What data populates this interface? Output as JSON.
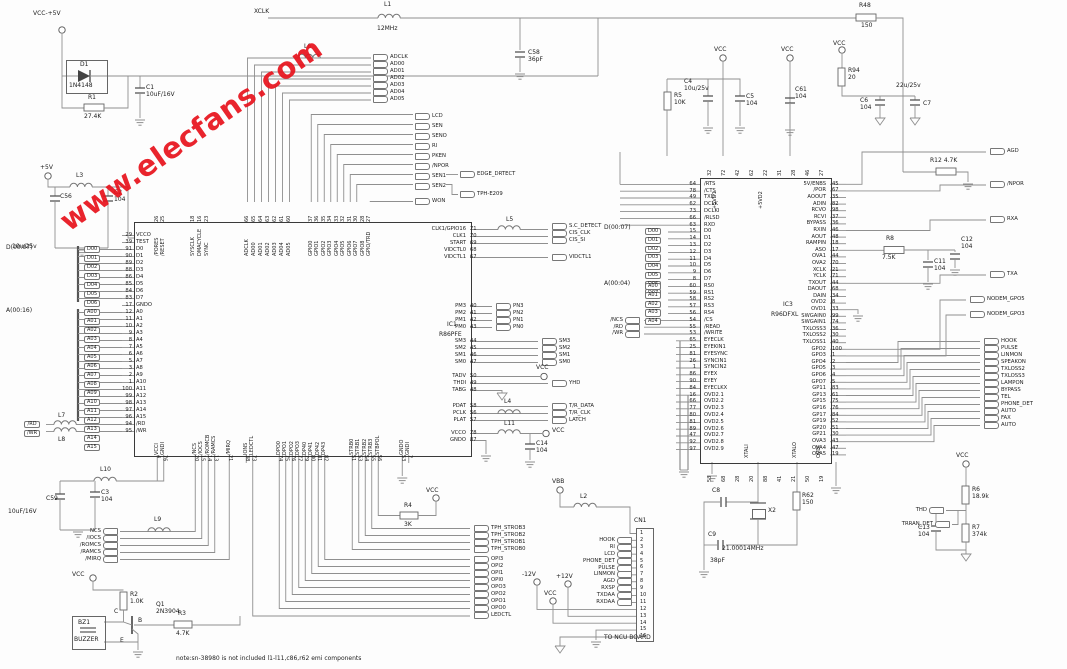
{
  "watermark": "www.elecfans.com",
  "note": "note:sn-38980 is not included l1-l11,c86,r62 emi components",
  "labels": {
    "vcc5": "VCC-+5V",
    "p5v": "+5V",
    "vcc": "VCC",
    "vbb": "VBB",
    "m12": "-12V",
    "p12": "+12V",
    "xclk": "XCLK",
    "to_ncu": "TO NCU BOARD",
    "cn1": "CN1",
    "d_bus1": "D(00:07)",
    "a_bus1": "A(00:16)",
    "d_bus3": "D(00:07)",
    "a_bus3": "A(00:04)",
    "p5vd1": "+5VD1",
    "p5vd2": "+5VD2",
    "xtali": "XTALI",
    "xtalo": "XTALO",
    "ovdi": "OVDI",
    "v22": "22u/25v",
    "b": "B",
    "c": "C",
    "e": "E",
    "won": "WON",
    "edge": "EDGE_DRTECT",
    "tph_e209": "TPH-E209",
    "vidctl1": "VIDCTL1",
    "yhd": "YHD",
    "ledctl": "LEDCTL",
    "agd": "AGD",
    "npor": "/NPOR",
    "rxa": "RXA",
    "txa": "TXA",
    "m5": "NODEM_GPO5",
    "m3": "NODEM_GPO3",
    "thd": "THD",
    "trran": "TRRAN_DET"
  },
  "parts": {
    "c1": {
      "n": "C1",
      "v": "10uF/16V"
    },
    "c2": {
      "n": "C2",
      "v": "104"
    },
    "c3": {
      "n": "C3",
      "v": "104"
    },
    "c4": {
      "n": "C4",
      "v": "10u/25v"
    },
    "c5": {
      "n": "C5",
      "v": "104"
    },
    "c6": {
      "n": "C6",
      "v": "104"
    },
    "c7": {
      "n": "C7",
      "v": "22u/25v"
    },
    "c8": {
      "n": "C8",
      "v": ""
    },
    "c9": {
      "n": "C9",
      "v": "38pF"
    },
    "c11": {
      "n": "C11",
      "v": "104"
    },
    "c12": {
      "n": "C12",
      "v": "104"
    },
    "c13": {
      "n": "C13",
      "v": "104"
    },
    "c14": {
      "n": "C14",
      "v": "104"
    },
    "c56": {
      "n": "C56",
      "v": "10u/25v"
    },
    "c58": {
      "n": "C58",
      "v": "36pF"
    },
    "c59": {
      "n": "C59",
      "v": "10uF/16V"
    },
    "c61": {
      "n": "C61",
      "v": "104"
    },
    "r1": {
      "n": "R1",
      "v": "27.4K"
    },
    "r2": {
      "n": "R2",
      "v": "1.0K"
    },
    "r3": {
      "n": "R3",
      "v": "4.7K"
    },
    "r4": {
      "n": "R4",
      "v": "3K"
    },
    "r5": {
      "n": "R5",
      "v": "10K"
    },
    "r6": {
      "n": "R6",
      "v": "18.9k"
    },
    "r7": {
      "n": "R7",
      "v": "374k"
    },
    "r8": {
      "n": "R8",
      "v": "7.5K"
    },
    "r12": {
      "n": "R12",
      "v": "4.7K"
    },
    "r48": {
      "n": "R48",
      "v": "150"
    },
    "r62": {
      "n": "R62",
      "v": "150"
    },
    "r94": {
      "n": "R94",
      "v": "20"
    },
    "d1": {
      "n": "D1",
      "v": "1N4148"
    },
    "q1": {
      "n": "Q1",
      "v": "2N3904"
    },
    "x2": {
      "n": "X2",
      "v": "21.00014MHz"
    },
    "bz1": {
      "n": "BZ1",
      "v": "BUZZER"
    },
    "l1": {
      "n": "L1",
      "v": "12MHz"
    },
    "l2": {
      "n": "L2"
    },
    "l3": {
      "n": "L3"
    },
    "l4": {
      "n": "L4"
    },
    "l5": {
      "n": "L5"
    },
    "l6": {
      "n": "L6"
    },
    "l7": {
      "n": "L7"
    },
    "l8": {
      "n": "L8"
    },
    "l9": {
      "n": "L9"
    },
    "l10": {
      "n": "L10"
    },
    "l11": {
      "n": "L11"
    }
  },
  "ic1": {
    "ref": "IC1",
    "part": "R86PFE",
    "top_a": [
      {
        "name": "/PORES",
        "pin": "26"
      },
      {
        "name": "/RESET",
        "pin": "25"
      }
    ],
    "top_b": [
      {
        "name": "SYSCLK",
        "pin": "18"
      },
      {
        "name": "DMACYCLE",
        "pin": "16"
      },
      {
        "name": "SYNC",
        "pin": "23"
      }
    ],
    "top_c": [
      {
        "name": "ADCLK",
        "pin": "66"
      },
      {
        "name": "AD00",
        "pin": "65"
      },
      {
        "name": "AD01",
        "pin": "64"
      },
      {
        "name": "AD02",
        "pin": "63"
      },
      {
        "name": "AD03",
        "pin": "62"
      },
      {
        "name": "AD04",
        "pin": "61"
      },
      {
        "name": "AD05",
        "pin": "60"
      }
    ],
    "top_d": [
      {
        "name": "GPIO0",
        "pin": "37"
      },
      {
        "name": "GPIO1",
        "pin": "36"
      },
      {
        "name": "GPIO2",
        "pin": "35"
      },
      {
        "name": "GPIO3",
        "pin": "34"
      },
      {
        "name": "GPIO4",
        "pin": "33"
      },
      {
        "name": "GPIO5",
        "pin": "32"
      },
      {
        "name": "GPIO6",
        "pin": "31"
      },
      {
        "name": "GPIO7",
        "pin": "30"
      },
      {
        "name": "GPIO8",
        "pin": "28"
      },
      {
        "name": "GPIO/TRD",
        "pin": "27"
      }
    ],
    "left": [
      {
        "name": "VCCO",
        "pin": "29"
      },
      {
        "name": "TEST",
        "pin": "39"
      },
      {
        "name": "D0",
        "pin": "91"
      },
      {
        "name": "D1",
        "pin": "90"
      },
      {
        "name": "D2",
        "pin": "89"
      },
      {
        "name": "D3",
        "pin": "88"
      },
      {
        "name": "D4",
        "pin": "86"
      },
      {
        "name": "D5",
        "pin": "85"
      },
      {
        "name": "D6",
        "pin": "84"
      },
      {
        "name": "D7",
        "pin": "83"
      },
      {
        "name": "GNDO",
        "pin": "17"
      },
      {
        "name": "A0",
        "pin": "12"
      },
      {
        "name": "A1",
        "pin": "11"
      },
      {
        "name": "A2",
        "pin": "10"
      },
      {
        "name": "A3",
        "pin": "9"
      },
      {
        "name": "A4",
        "pin": "8"
      },
      {
        "name": "A5",
        "pin": "7"
      },
      {
        "name": "A6",
        "pin": "6"
      },
      {
        "name": "A7",
        "pin": "5"
      },
      {
        "name": "A8",
        "pin": "3"
      },
      {
        "name": "A9",
        "pin": "2"
      },
      {
        "name": "A10",
        "pin": "1"
      },
      {
        "name": "A11",
        "pin": "100"
      },
      {
        "name": "A12",
        "pin": "99"
      },
      {
        "name": "A13",
        "pin": "98"
      },
      {
        "name": "A14",
        "pin": "97"
      },
      {
        "name": "A15",
        "pin": "96"
      },
      {
        "name": "/RD",
        "pin": "94"
      },
      {
        "name": "/WR",
        "pin": "95"
      }
    ],
    "r0": [
      {
        "name": "CLK1/GPIO16",
        "pin": "71"
      },
      {
        "name": "CLK1",
        "pin": "70"
      },
      {
        "name": "START",
        "pin": "69"
      },
      {
        "name": "VIDCTL0",
        "pin": "68"
      },
      {
        "name": "VIDCTL1",
        "pin": "67"
      }
    ],
    "r1": [
      {
        "name": "PM3",
        "pin": "40"
      },
      {
        "name": "PM2",
        "pin": "41"
      },
      {
        "name": "PM1",
        "pin": "42"
      },
      {
        "name": "PM0",
        "pin": "43"
      }
    ],
    "r2": [
      {
        "name": "SM3",
        "pin": "44"
      },
      {
        "name": "SM2",
        "pin": "45"
      },
      {
        "name": "SM1",
        "pin": "46"
      },
      {
        "name": "SM0",
        "pin": "47"
      }
    ],
    "r3": [
      {
        "name": "TADV",
        "pin": "50"
      },
      {
        "name": "THDI",
        "pin": "49"
      },
      {
        "name": "TABG",
        "pin": "48"
      }
    ],
    "r4": [
      {
        "name": "PDAT",
        "pin": "58"
      },
      {
        "name": "PCLK",
        "pin": "56"
      },
      {
        "name": "PLAT",
        "pin": "57"
      }
    ],
    "r5": [
      {
        "name": "VCCO",
        "pin": "78"
      },
      {
        "name": "GNDO",
        "pin": "87"
      }
    ],
    "b_a": [
      {
        "name": "VCCI",
        "pin": "4"
      },
      {
        "name": "GNDI",
        "pin": "76"
      }
    ],
    "b_b": [
      {
        "name": "/NCS",
        "pin": "20"
      },
      {
        "name": "/IOCS",
        "pin": "15"
      },
      {
        "name": "/ROMCB",
        "pin": "14"
      },
      {
        "name": "/RAMCS",
        "pin": "13"
      }
    ],
    "b_c": [
      {
        "name": "/MIRQ",
        "pin": "21"
      }
    ],
    "b_d": [
      {
        "name": "IONS",
        "pin": "38"
      },
      {
        "name": "LEDCTL",
        "pin": "73"
      }
    ],
    "b_e": [
      {
        "name": "DPO0",
        "pin": "74"
      },
      {
        "name": "DPO1",
        "pin": "75"
      },
      {
        "name": "DPO2",
        "pin": "76"
      },
      {
        "name": "DPO3",
        "pin": "77"
      },
      {
        "name": "DP40",
        "pin": "79"
      },
      {
        "name": "DP41",
        "pin": "80"
      },
      {
        "name": "DP42",
        "pin": "81"
      },
      {
        "name": "DP43",
        "pin": "82"
      }
    ],
    "b_f": [
      {
        "name": "STRB0",
        "pin": "51"
      },
      {
        "name": "STRB1",
        "pin": "53"
      },
      {
        "name": "STRB2",
        "pin": "54"
      },
      {
        "name": "STRB3",
        "pin": "55"
      },
      {
        "name": "STBPOL",
        "pin": "56"
      }
    ],
    "b_g": [
      {
        "name": "GNDO",
        "pin": "53"
      },
      {
        "name": "GNDI",
        "pin": "7"
      }
    ]
  },
  "ic3": {
    "ref": "IC3",
    "part": "R96DFXL",
    "top_nums": [
      "32",
      "72",
      "42",
      "62",
      "22",
      "31",
      "28",
      "46",
      "27"
    ],
    "bot_nums": [
      "53",
      "68",
      "28",
      "20",
      "88",
      "41",
      "21",
      "50",
      "19"
    ],
    "left": [
      {
        "name": "/RTS",
        "pin": "64"
      },
      {
        "name": "/CTS",
        "pin": "78"
      },
      {
        "name": "TXD",
        "pin": "49"
      },
      {
        "name": "DCLK",
        "pin": "62"
      },
      {
        "name": "DCLKI",
        "pin": "73"
      },
      {
        "name": "/RLSD",
        "pin": "66"
      },
      {
        "name": "RXD",
        "pin": "63"
      },
      {
        "name": "D0",
        "pin": "15"
      },
      {
        "name": "D1",
        "pin": "14"
      },
      {
        "name": "D2",
        "pin": "13"
      },
      {
        "name": "D3",
        "pin": "12"
      },
      {
        "name": "D4",
        "pin": "11"
      },
      {
        "name": "D5",
        "pin": "10"
      },
      {
        "name": "D6",
        "pin": "9"
      },
      {
        "name": "D7",
        "pin": "8"
      },
      {
        "name": "RS0",
        "pin": "60"
      },
      {
        "name": "RS1",
        "pin": "59"
      },
      {
        "name": "RS2",
        "pin": "58"
      },
      {
        "name": "RS3",
        "pin": "57"
      },
      {
        "name": "RS4",
        "pin": "56"
      },
      {
        "name": "/CS",
        "pin": "54"
      },
      {
        "name": "/READ",
        "pin": "55"
      },
      {
        "name": "/WRITE",
        "pin": "53"
      },
      {
        "name": "EYECLK",
        "pin": "65"
      },
      {
        "name": "EYEKIN1",
        "pin": "25"
      },
      {
        "name": "EYESYNC",
        "pin": "81"
      },
      {
        "name": "SYNCIN1",
        "pin": "26"
      },
      {
        "name": "SYNCIN2",
        "pin": "1"
      },
      {
        "name": "EYEX",
        "pin": "86"
      },
      {
        "name": "EYEY",
        "pin": "90"
      },
      {
        "name": "EYECLKX",
        "pin": "84"
      },
      {
        "name": "OVD2.1",
        "pin": "16"
      },
      {
        "name": "OVD2.2",
        "pin": "66"
      },
      {
        "name": "OVD2.3",
        "pin": "77"
      },
      {
        "name": "OVD2.4",
        "pin": "80"
      },
      {
        "name": "OVD2.5",
        "pin": "81"
      },
      {
        "name": "OVD2.6",
        "pin": "89"
      },
      {
        "name": "OVD2.7",
        "pin": "47"
      },
      {
        "name": "OVD2.8",
        "pin": "92"
      },
      {
        "name": "OVD2.9",
        "pin": "97"
      }
    ],
    "right": [
      {
        "name": "5V/ENBS",
        "pin": "45"
      },
      {
        "name": "/POR",
        "pin": "67"
      },
      {
        "name": "AOOUT",
        "pin": "35"
      },
      {
        "name": "ADIN",
        "pin": "82"
      },
      {
        "name": "RCVO",
        "pin": "98"
      },
      {
        "name": "RCVI",
        "pin": "37"
      },
      {
        "name": "BYPASS",
        "pin": "36"
      },
      {
        "name": "RXIN",
        "pin": "46"
      },
      {
        "name": "AOUT",
        "pin": "48"
      },
      {
        "name": "RAMPIN",
        "pin": "18"
      },
      {
        "name": "ASO",
        "pin": "17"
      },
      {
        "name": "OVA1",
        "pin": "44"
      },
      {
        "name": "OVA2",
        "pin": "70"
      },
      {
        "name": "XCLK",
        "pin": "21"
      },
      {
        "name": "YCLK",
        "pin": "71"
      },
      {
        "name": "TXOUT",
        "pin": "44"
      },
      {
        "name": "DAOUT",
        "pin": "68"
      },
      {
        "name": "DAIN",
        "pin": "34"
      },
      {
        "name": "OVD2",
        "pin": "8"
      },
      {
        "name": "OVD1",
        "pin": "33"
      },
      {
        "name": "SWGAIN0",
        "pin": "99"
      },
      {
        "name": "SWGAIN1",
        "pin": "74"
      },
      {
        "name": "TXLOSS3",
        "pin": "36"
      },
      {
        "name": "TXLOSS2",
        "pin": "30"
      },
      {
        "name": "TXLOSS1",
        "pin": "40"
      },
      {
        "name": "GPO2",
        "pin": "100"
      },
      {
        "name": "GPO3",
        "pin": "1"
      },
      {
        "name": "GPO4",
        "pin": "2"
      },
      {
        "name": "GPO5",
        "pin": "3"
      },
      {
        "name": "GPO6",
        "pin": "4"
      },
      {
        "name": "GPO7",
        "pin": "5"
      },
      {
        "name": "GP11",
        "pin": "83"
      },
      {
        "name": "GP13",
        "pin": "61"
      },
      {
        "name": "GP15",
        "pin": "75"
      },
      {
        "name": "GP16",
        "pin": "76"
      },
      {
        "name": "GP17",
        "pin": "84"
      },
      {
        "name": "GP19",
        "pin": "52"
      },
      {
        "name": "GP20",
        "pin": "51"
      },
      {
        "name": "GP21",
        "pin": "30"
      },
      {
        "name": "OVA3",
        "pin": "43"
      },
      {
        "name": "OVA4",
        "pin": "47"
      },
      {
        "name": "OVA5",
        "pin": "19"
      }
    ]
  },
  "tags": {
    "ad": [
      "ADCLK",
      "AD00",
      "AD01",
      "AD02",
      "AD03",
      "AD04",
      "AD05"
    ],
    "misc": [
      "LCD",
      "SEN",
      "SENO",
      "RI",
      "PKEN",
      "/NPOR",
      "SEN1",
      "SEN2"
    ],
    "cis": [
      "S.C_DETECT",
      "CIS_CLK",
      "CIS_SI"
    ],
    "pn": [
      "PN3",
      "PN2",
      "PN1",
      "PN0"
    ],
    "sm": [
      "SM3",
      "SM2",
      "SM1",
      "SM0"
    ],
    "tr": [
      "T/R_DATA",
      "T/R_CLK",
      "LATCH"
    ],
    "d1": [
      "D00",
      "D01",
      "D02",
      "D03",
      "D04",
      "D05",
      "D06",
      "D07"
    ],
    "a1": [
      "A00",
      "A01",
      "A02",
      "A03",
      "A04",
      "A05",
      "A06",
      "A07",
      "A08",
      "A09",
      "A10",
      "A11",
      "A12",
      "A13",
      "A14",
      "A15"
    ],
    "rdwr": [
      "/RD",
      "/WR"
    ],
    "ncs": [
      "NCS",
      "/IOCS",
      "/ROMCS",
      "/RAMCS",
      "/MIRQ"
    ],
    "tph": [
      "TPH_STROB3",
      "TPH_STROB2",
      "TPH_STROB1",
      "TPH_STROB0"
    ],
    "opi": [
      "OPI3",
      "OPI2",
      "OPI1",
      "OPI0"
    ],
    "opo": [
      "OPO3",
      "OPO2",
      "OPO1",
      "OPO0"
    ],
    "cn": [
      "HOOK",
      "RI",
      "LCD",
      "PHONE_DET",
      "PULSE",
      "LINMON",
      "AGD",
      "RXSP",
      "TXDAA",
      "RXDAA"
    ],
    "d3": [
      "D00",
      "D01",
      "D02",
      "D03",
      "D04",
      "D05",
      "D06",
      "D07"
    ],
    "a3": [
      "A00",
      "A01",
      "A02",
      "A03",
      "A04"
    ],
    "ctrl3": [
      "/NCS",
      "/RD",
      "/WR"
    ],
    "right": [
      "HOOK",
      "PULSE",
      "LINMON",
      "SPEAKON",
      "TXLOSS2",
      "TXLOSS3",
      "LAMPON",
      "BYPASS",
      "TEL",
      "PHONE_DET",
      "AUTO",
      "FAX",
      "AUTO"
    ]
  },
  "cn_pins": [
    "1",
    "2",
    "3",
    "4",
    "5",
    "6",
    "7",
    "8",
    "9",
    "10",
    "11",
    "12",
    "13",
    "14",
    "15",
    "16"
  ]
}
